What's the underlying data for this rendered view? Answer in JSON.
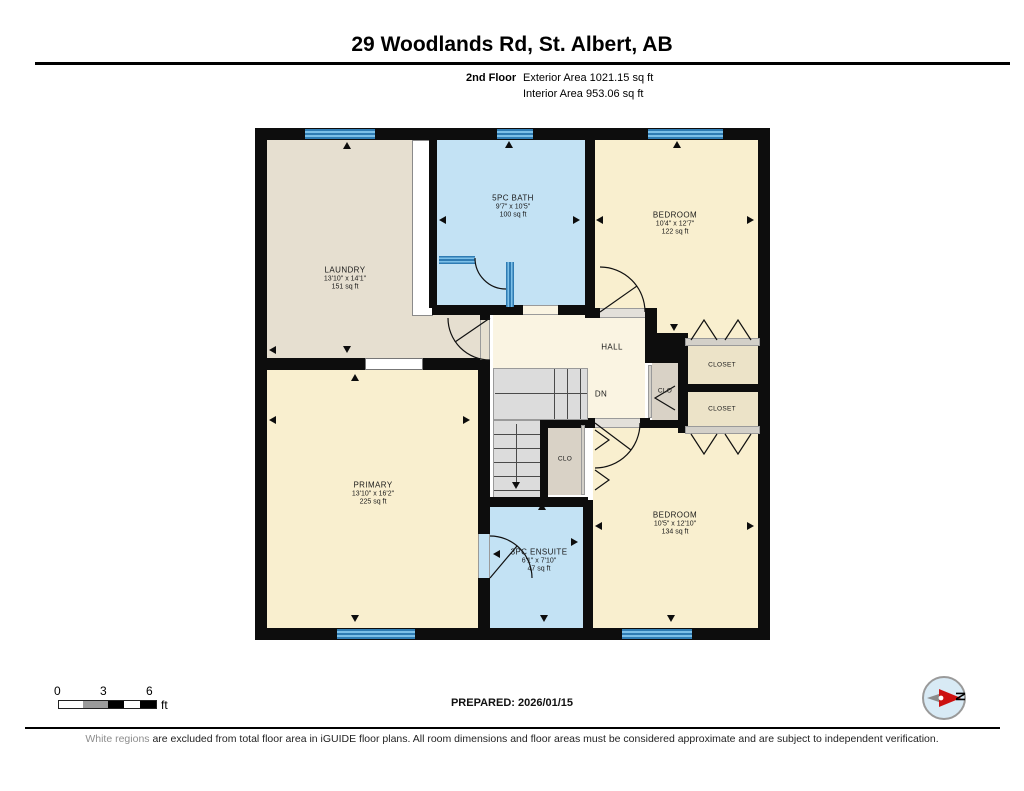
{
  "header": {
    "address": "29 Woodlands Rd, St. Albert, AB",
    "floor": "2nd Floor",
    "exterior": "Exterior Area 1021.15 sq ft",
    "interior": "Interior Area 953.06 sq ft"
  },
  "rooms": {
    "laundry": {
      "name": "LAUNDRY",
      "dims": "13'10\" x 14'1\"",
      "area": "151 sq ft"
    },
    "bath": {
      "name": "5PC BATH",
      "dims": "9'7\" x 10'5\"",
      "area": "100 sq ft"
    },
    "bedroom1": {
      "name": "BEDROOM",
      "dims": "10'4\" x 12'7\"",
      "area": "122 sq ft"
    },
    "bedroom2": {
      "name": "BEDROOM",
      "dims": "10'5\" x 12'10\"",
      "area": "134 sq ft"
    },
    "primary": {
      "name": "PRIMARY",
      "dims": "13'10\" x 16'2\"",
      "area": "225 sq ft"
    },
    "ensuite": {
      "name": "3PC ENSUITE",
      "dims": "6'1\" x 7'10\"",
      "area": "47 sq ft"
    },
    "hall": {
      "name": "HALL"
    },
    "stairs": {
      "label": "DN"
    },
    "closet_hall": {
      "name": "CLO"
    },
    "closet_primary": {
      "name": "CLO"
    },
    "closet_top": {
      "name": "CLOSET"
    },
    "closet_bottom": {
      "name": "CLOSET"
    }
  },
  "scalebar": {
    "t0": "0",
    "t3": "3",
    "t6": "6",
    "unit": "ft"
  },
  "prepared": "PREPARED: 2026/01/15",
  "disclaimer": {
    "prefix": "White regions",
    "rest": " are excluded from total floor area in iGUIDE floor plans. All room dimensions and floor areas must be considered approximate and are subject to independent verification."
  },
  "compass": {
    "north": "N"
  },
  "colors": {
    "wall": "#0d0d0d",
    "bedroom_fill": "#f9efcf",
    "bath_fill": "#c3e2f4",
    "laundry_fill": "#e6dfd0",
    "hall_fill": "#faf4e2",
    "closet_fill": "#ece3c8",
    "closet_gray_fill": "#d9d2c6",
    "stairs_fill": "#dcdcdc",
    "window_blue": "#4a9fd8",
    "compass_red": "#cc1111"
  }
}
